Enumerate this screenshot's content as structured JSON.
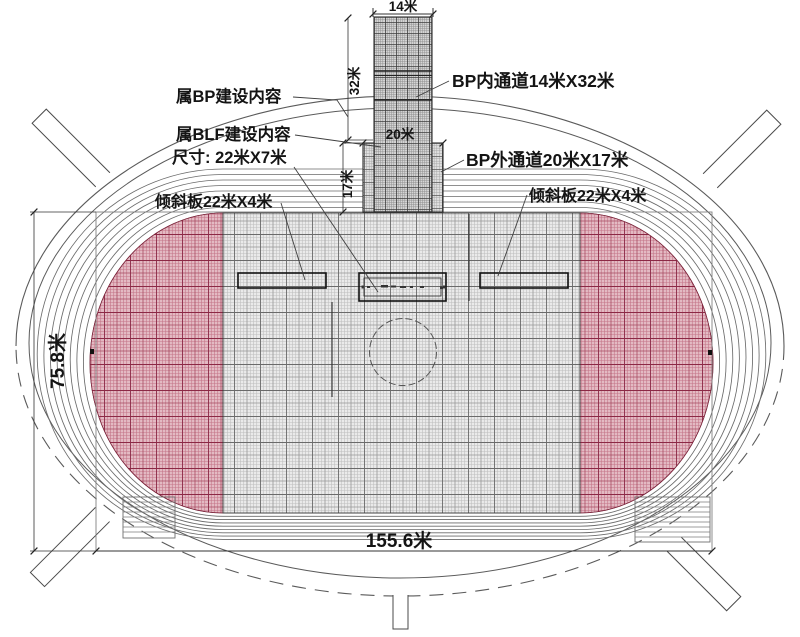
{
  "diagram": {
    "title_context": "stadium / track construction plan",
    "labels": {
      "bp_scope": "属BP建设内容",
      "blf_scope": "属BLF建设内容",
      "blf_size": "尺寸: 22米X7米",
      "ramp_left": "倾斜板22米X4米",
      "ramp_right": "倾斜板22米X4米",
      "bp_inner_corridor": "BP内通道14米X32米",
      "bp_outer_corridor": "BP外通道20米X17米"
    },
    "dimensions": {
      "inner_corridor_width": "14米",
      "inner_corridor_length": "32米",
      "outer_corridor_width": "20米",
      "outer_corridor_length": "17米",
      "field_height": "75.8米",
      "field_width": "155.6米"
    },
    "colors": {
      "red_zone": "#c76b7f",
      "field_gray": "#eaeaea",
      "line": "#3c3c3c"
    }
  }
}
